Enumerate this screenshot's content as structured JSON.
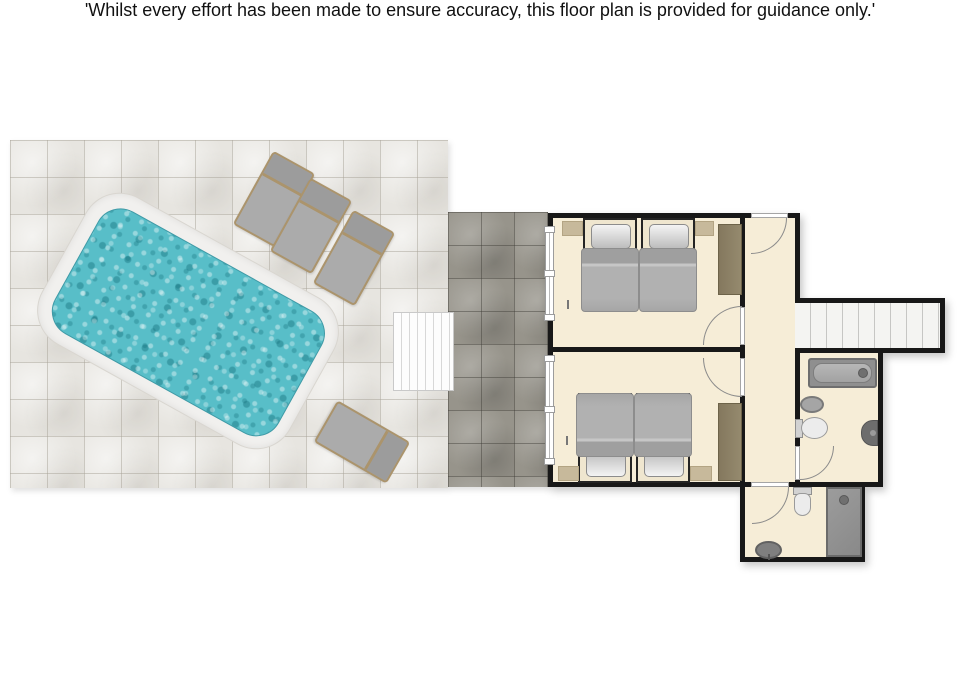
{
  "disclaimer": {
    "text": "'Whilst every effort has been made to ensure accuracy, this floor plan is provided for guidance only.'"
  },
  "floorplan": {
    "rooms": [
      {
        "name": "bedroom-top",
        "furniture": [
          "twin-bed",
          "twin-bed",
          "wardrobe",
          "rug",
          "rug"
        ],
        "features": [
          "sliding-window",
          "door"
        ]
      },
      {
        "name": "bedroom-bottom",
        "furniture": [
          "twin-bed",
          "twin-bed",
          "wardrobe",
          "rug",
          "rug"
        ],
        "features": [
          "sliding-window",
          "door"
        ]
      },
      {
        "name": "hallway",
        "features": [
          "entrance-door"
        ]
      },
      {
        "name": "staircase",
        "treads": 9
      },
      {
        "name": "bathroom",
        "fixtures": [
          "bathtub",
          "washbasin",
          "toilet",
          "wall-unit"
        ],
        "features": [
          "door"
        ]
      },
      {
        "name": "shower-room",
        "fixtures": [
          "toilet",
          "shower",
          "washbasin"
        ],
        "features": [
          "door"
        ]
      }
    ]
  },
  "outdoor": {
    "pool": {
      "shape": "rounded-rectangle",
      "rotation_deg": 29,
      "water_color": "#58bec8",
      "coping_color": "#f1f0ee"
    },
    "sun_loungers": {
      "count": 4
    },
    "pool_steps": {
      "stripes": 7
    },
    "terrace": {
      "tile_color": "#e7e5e0"
    },
    "walkway": {
      "tile_color": "#97948b"
    }
  },
  "colors": {
    "floor": "#f6edd7",
    "walls": "#181818",
    "wardrobe": "#8b7f64",
    "water": "#58bec8",
    "background": "#ffffff"
  }
}
